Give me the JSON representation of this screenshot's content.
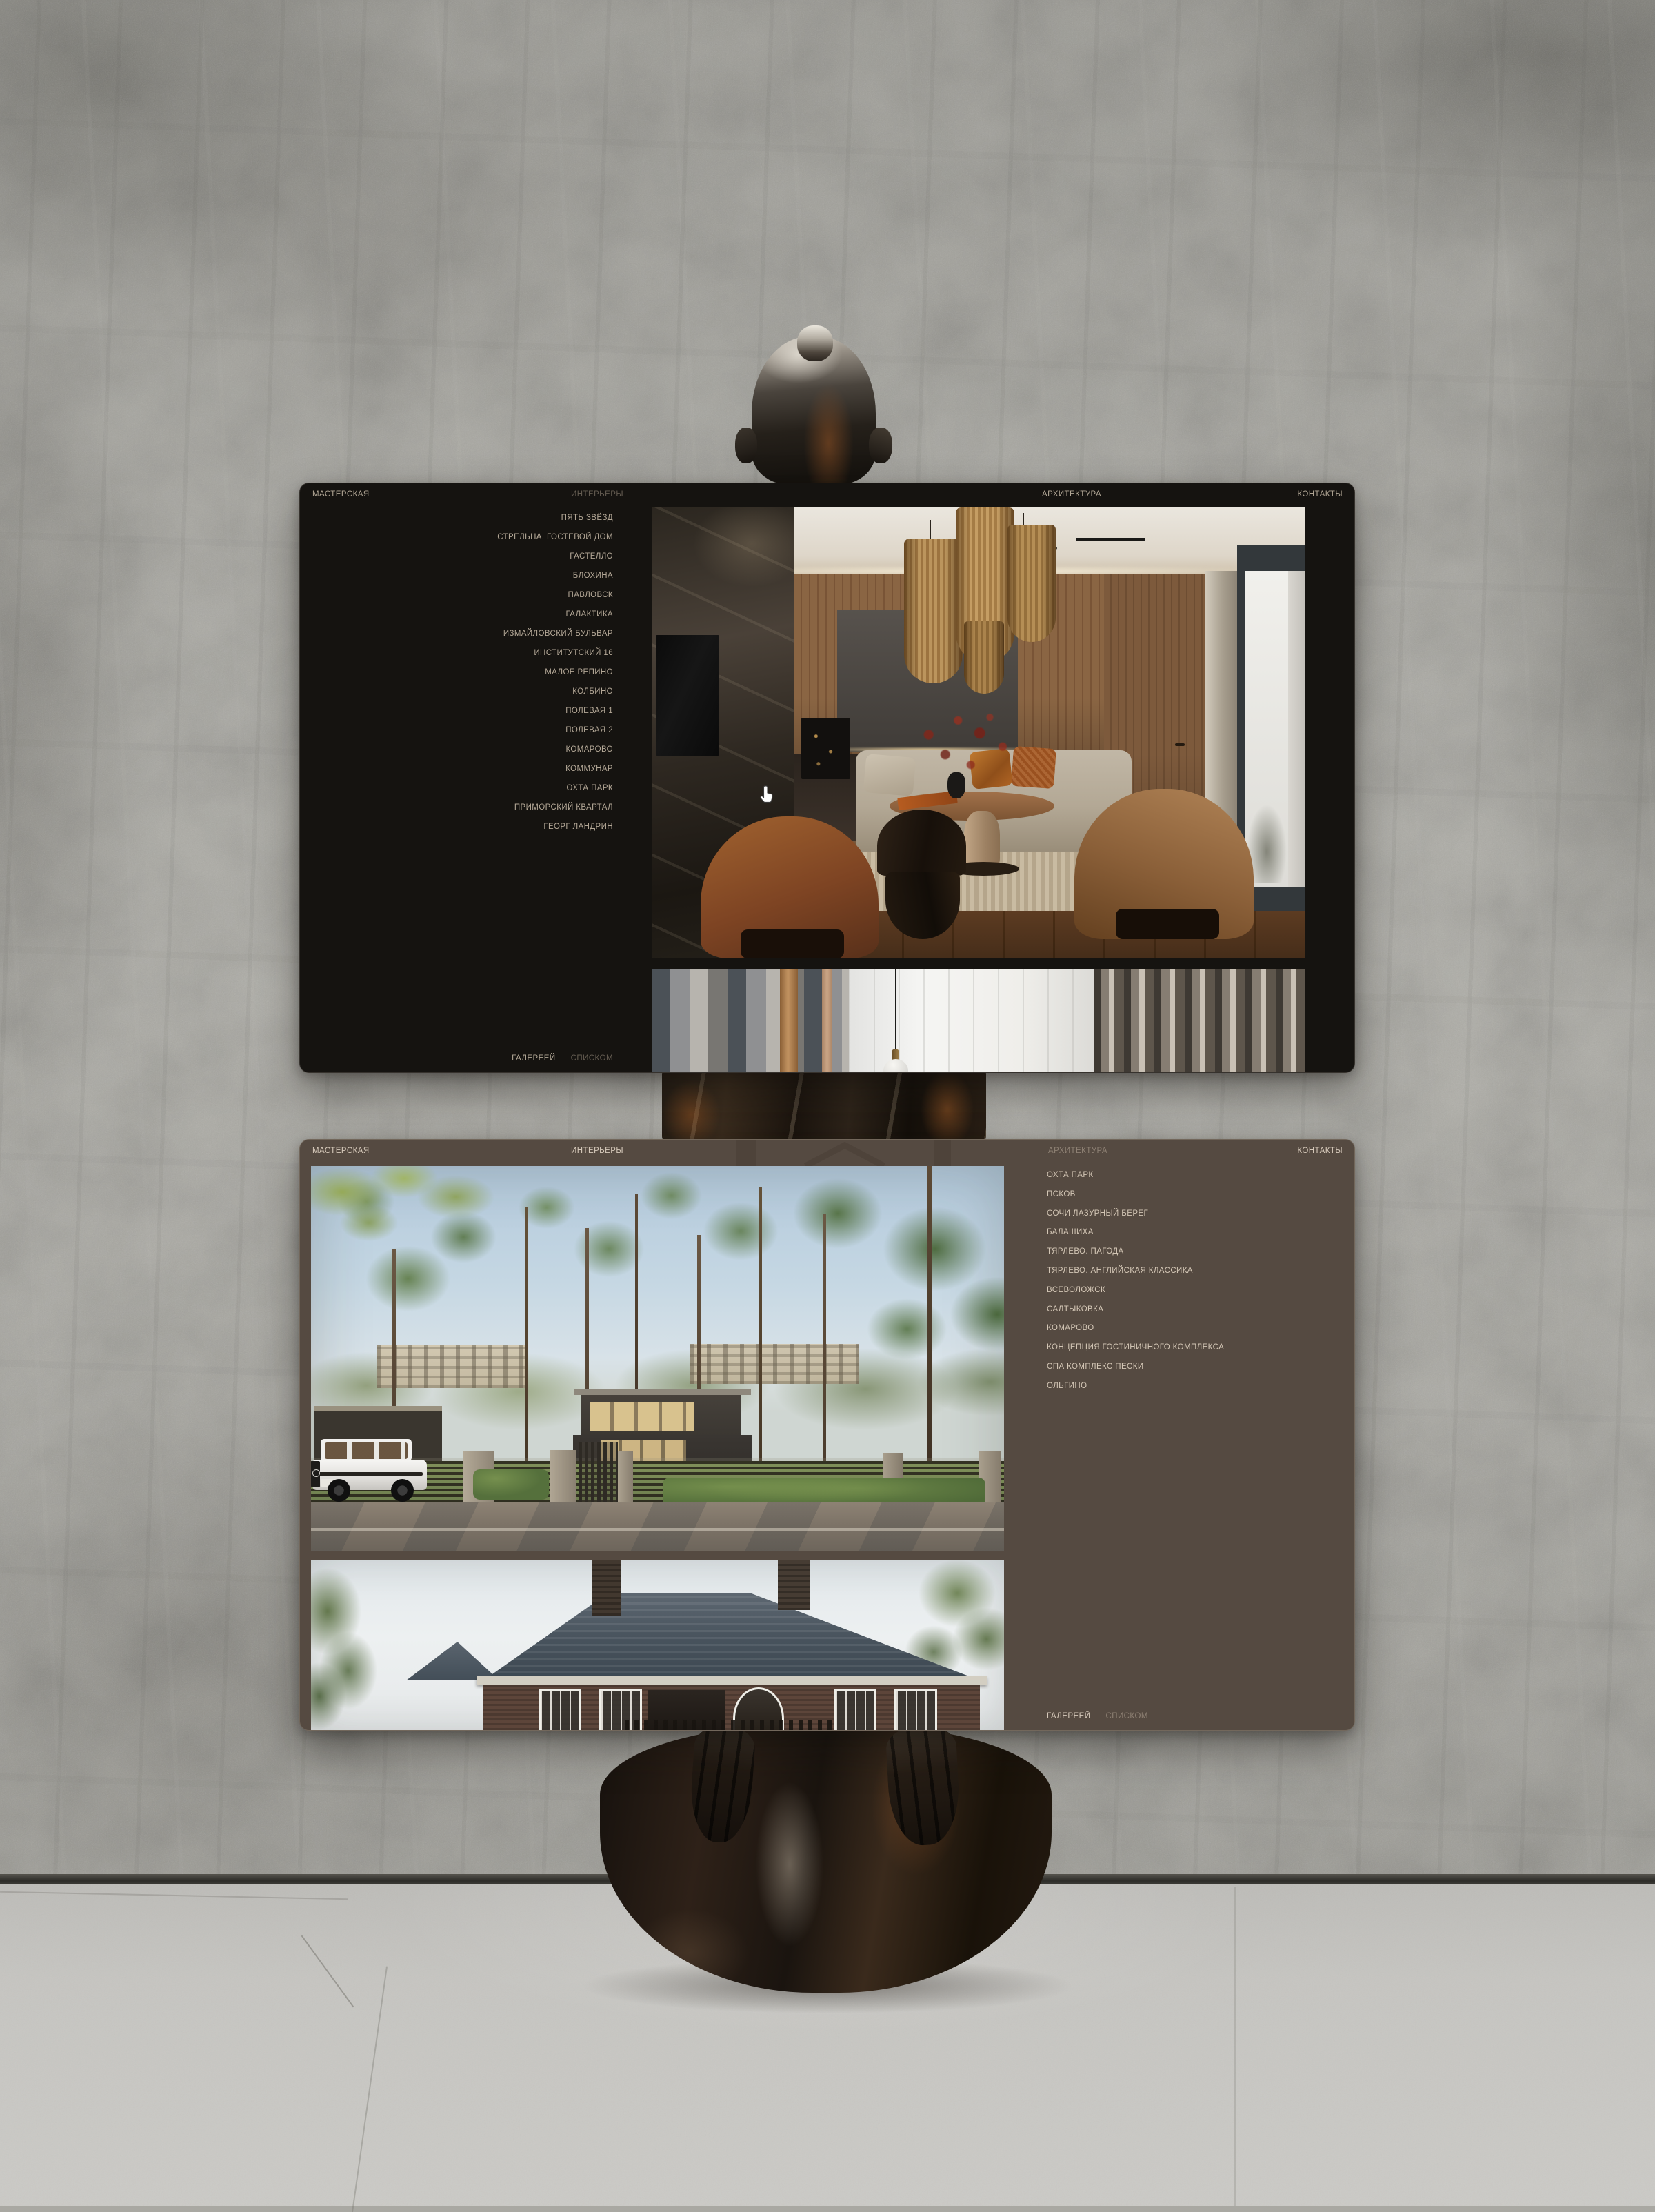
{
  "top_window": {
    "header": {
      "brand": "МАСТЕРСКАЯ",
      "nav_interiors": "ИНТЕРЬЕРЫ",
      "nav_architecture": "АРХИТЕКТУРА",
      "nav_contacts": "КОНТАКТЫ"
    },
    "menu": [
      "ПЯТЬ ЗВЁЗД",
      "СТРЕЛЬНА. ГОСТЕВОЙ ДОМ",
      "ГАСТЕЛЛО",
      "БЛОХИНА",
      "ПАВЛОВСК",
      "ГАЛАКТИКА",
      "ИЗМАЙЛОВСКИЙ БУЛЬВАР",
      "ИНСТИТУТСКИЙ 16",
      "МАЛОЕ РЕПИНО",
      "КОЛБИНО",
      "ПОЛЕВАЯ 1",
      "ПОЛЕВАЯ 2",
      "КОМАРОВО",
      "КОММУНАР",
      "ОХТА ПАРК",
      "ПРИМОРСКИЙ КВАРТАЛ",
      "ГЕОРГ ЛАНДРИН"
    ],
    "footer": {
      "gallery": "ГАЛЕРЕЕЙ",
      "list": "СПИСКОМ"
    }
  },
  "bottom_window": {
    "header": {
      "brand": "МАСТЕРСКАЯ",
      "nav_interiors": "ИНТЕРЬЕРЫ",
      "nav_architecture": "АРХИТЕКТУРА",
      "nav_contacts": "КОНТАКТЫ"
    },
    "menu": [
      "ОХТА ПАРК",
      "ПСКОВ",
      "СОЧИ ЛАЗУРНЫЙ БЕРЕГ",
      "БАЛАШИХА",
      "ТЯРЛЕВО. ПАГОДА",
      "ТЯРЛЕВО. АНГЛИЙСКАЯ КЛАССИКА",
      "ВСЕВОЛОЖСК",
      "САЛТЫКОВКА",
      "КОМАРОВО",
      "КОНЦЕПЦИЯ ГОСТИНИЧНОГО КОМПЛЕКСА",
      "СПА КОМПЛЕКС ПЕСКИ",
      "ОЛЬГИНО"
    ],
    "footer": {
      "gallery": "ГАЛЕРЕЕЙ",
      "list": "СПИСКОМ"
    }
  },
  "colors": {
    "dark_window_bg": "#151310",
    "brown_window_bg": "#554a41",
    "dark_window_text": "#b1a695",
    "dark_window_text_dim": "#645c51",
    "brown_window_text": "#d7cabb",
    "brown_window_text_dim": "#8e8174"
  }
}
